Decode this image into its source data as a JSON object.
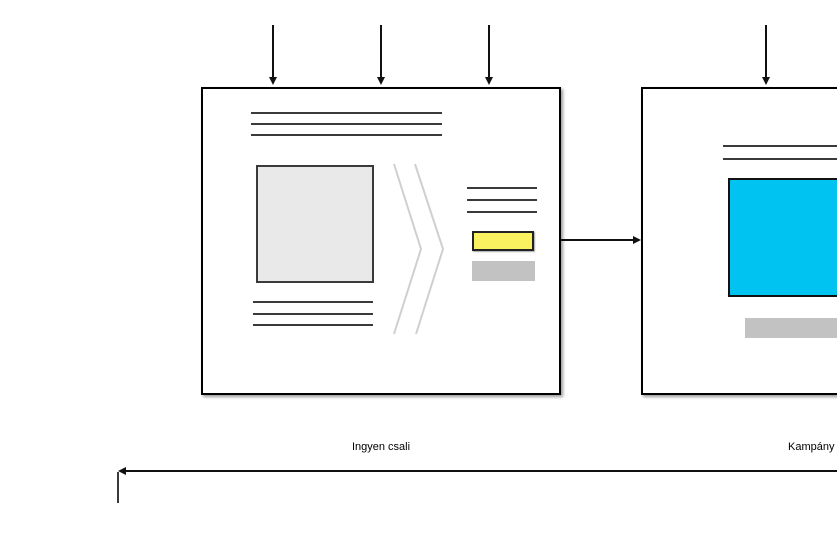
{
  "diagram": {
    "nodes": {
      "lead_magnet_page": {
        "label": "Ingyen csali"
      },
      "campaign_page": {
        "label": "Kampány o"
      }
    },
    "colors": {
      "cta_yellow": "#F9F160",
      "hero_cyan": "#00C3F2",
      "bar_gray": "#C2C2C2",
      "image_gray": "#E9E9E9",
      "arrow_black": "#111111",
      "sketch_line": "#3A3A3A",
      "chevron_gray": "#CFCFCF"
    }
  }
}
